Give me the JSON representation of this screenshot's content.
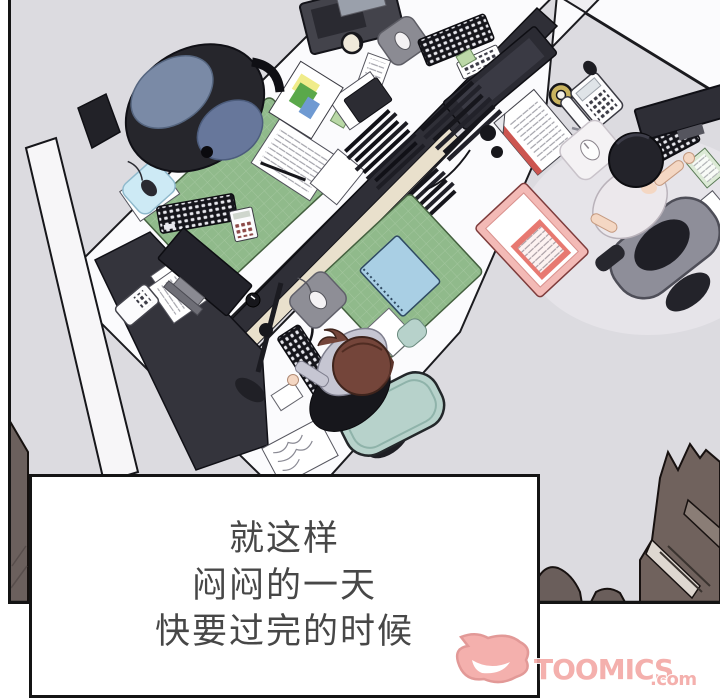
{
  "caption": {
    "lines": [
      "就这样",
      "闷闷的一天",
      "快要过完的时候"
    ],
    "text_color": "#474747",
    "box_background": "#ffffff",
    "border_color": "#141414"
  },
  "watermark": {
    "text": "TOOMICS",
    "suffix": ".com",
    "color": "#f3a8a5"
  },
  "panel": {
    "floor_color": "#dcdbe0",
    "desk_color": "#fbfbfd",
    "border_color": "#141414"
  },
  "palette": {
    "green_mat": "#90ba8b",
    "divider_dark": "#2f2f37",
    "light_strip": "#e9e0cc",
    "mousepad_blue": "#cdeaf5",
    "chair_slate_blue": "#7a8aa6",
    "chair_mint": "#b7d2cb",
    "chair_gray": "#8e8e99",
    "hair_brown": "#74453a",
    "hair_black": "#23232a",
    "skin": "#f4d7c3",
    "folder_pink": "#f3bab6",
    "notebook_blue": "#a9cfe4",
    "tape_gold": "#c9b35f",
    "silhouette_brown": "#6b605d"
  }
}
